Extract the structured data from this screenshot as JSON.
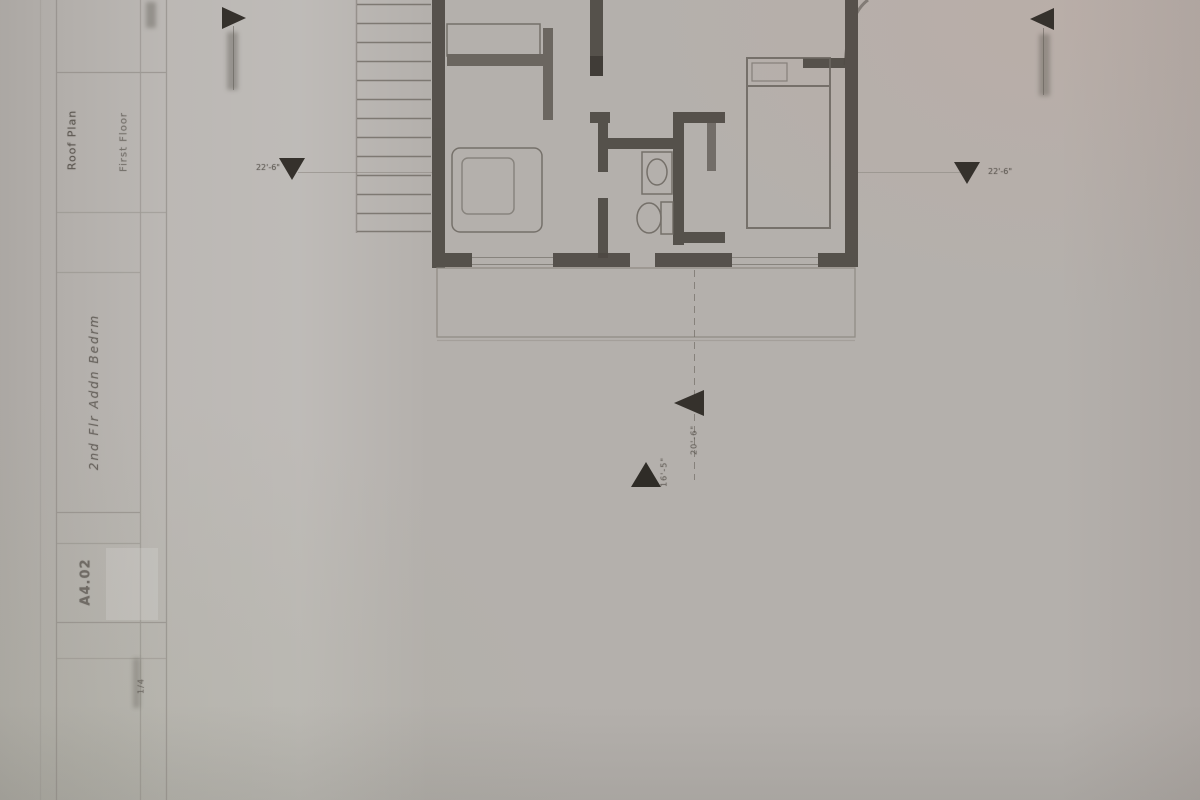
{
  "document": {
    "kind": "scanned architectural floor plan sheet",
    "orientation_note": "title block text rotated 90 degrees along left edge"
  },
  "colors": {
    "paper": "#b4b0ac",
    "ink": "#35312c",
    "wall": "#4e4943",
    "faint_line": "#8e8983"
  },
  "title_block": {
    "project_field": "Roof Plan",
    "secondary_field": "First Floor",
    "handwritten_note": "2nd Flr Addn Bedrm",
    "sheet_number": "A4.02",
    "scale_note": "1/4"
  },
  "markers": {
    "section_top_left": {
      "icon": "triangle-right",
      "label": ""
    },
    "section_top_right": {
      "icon": "triangle-left",
      "label": ""
    },
    "level_left": {
      "icon": "triangle-down",
      "label": "22'-6\""
    },
    "level_right": {
      "icon": "triangle-down",
      "label": "22'-6\""
    },
    "mid_left": {
      "icon": "triangle-left",
      "label": "20'-6\""
    },
    "mid_up": {
      "icon": "triangle-up",
      "label": "16'-5\""
    }
  },
  "plan": {
    "elements": [
      "staircase",
      "left-bedroom",
      "bathroom",
      "right-bedroom",
      "deck-outline",
      "center-dashed-line"
    ]
  }
}
